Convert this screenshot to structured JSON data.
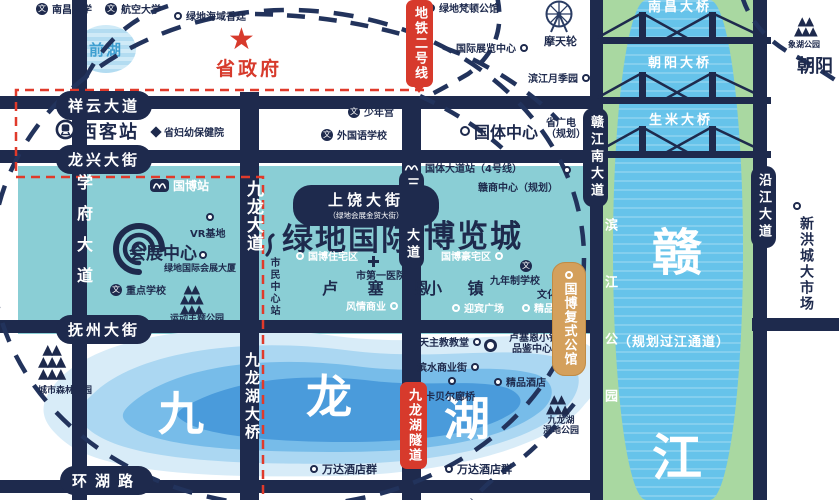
{
  "colors": {
    "navy": "#1e2a4d",
    "teal": "#8aced5",
    "red": "#d73a2c",
    "gold": "#d4a05c",
    "water_blue": "#66c3ea",
    "bank_green": "#a9d8a1",
    "lake_core_blue": "#4a9bdb",
    "qianhu_blue": "#b3dcf1"
  },
  "icons": {
    "star": "★",
    "school_glyph": "文",
    "mountain_row_small": "▲▲",
    "mountain_row_large": "▲▲▲"
  },
  "top": {
    "nanchang_university": "南昌大学",
    "aviation_university": "航空大学",
    "greenland_haiyu": "绿地海域香廷",
    "greenland_fandun": "绿地梵顿公馆",
    "qianhu_lake": "前湖",
    "provincial_government": "省政府",
    "intl_exhibition_center": "国际展览中心",
    "ferris_wheel": "摩天轮",
    "binjiang_rose_garden": "滨江月季园",
    "youth_palace": "少年宫",
    "foreign_language_school": "外国语学校",
    "provincial_maternity_hospital": "省妇幼保健院",
    "guoti_center": "国体中心",
    "provincial_tv_line1": "省广电",
    "provincial_tv_line2": "（规划）",
    "xianghu_park": "象湖公园",
    "chaoyang_district": "朝阳"
  },
  "metro": {
    "line2_banner": "地铁二号线",
    "west_station": "西客站",
    "guobo_station": "国博站",
    "guoti_avenue_station": "国体大道站（4号线）",
    "civic_center_station": "市民中心站"
  },
  "roads": {
    "xiangyun_avenue": "祥云大道",
    "longxing_street": "龙兴大街",
    "fuzhou_street": "抚州大街",
    "huanhu_road": "环湖路",
    "xuefu_avenue": "学府大道",
    "jiulong_avenue": "九龙大道",
    "sanqingshan_avenue": "三清山大道",
    "ganjiangnan_avenue": "赣江南大道",
    "yanjiang_avenue": "沿江大道",
    "shangrao_street": "上饶大街",
    "shangrao_street_sub": "（绿地会展金贸大街）"
  },
  "bridges": {
    "nanchang": "南昌大桥",
    "chaoyang": "朝阳大桥",
    "shengmi": "生米大桥",
    "jiulonghu_bridge": "九龙湖大桥",
    "jiulonghu_tunnel": "九龙湖隧道"
  },
  "project": {
    "greenland_intl": "绿地国际",
    "expo_city": "博览城",
    "convention_center": "会展中心",
    "lucerne_town_left": "卢 塞 恩",
    "lucerne_town_right": "小 镇",
    "guobo_duplex_mansion": "国博复式公馆",
    "vr_base": "VR基地",
    "greenland_conv_tower": "绿地国际会展大厦",
    "key_school": "重点学校",
    "sports_theme_park": "运动主题公园",
    "guobo_residential": "国博住宅区",
    "city_first_hospital": "市第一医院",
    "guobo_luxury": "国博豪宅区",
    "nine_year_school": "九年制学校",
    "culture_center": "文化中心",
    "fengqing_commerce": "风情商业",
    "yingbin_plaza": "迎宾广场",
    "boutique_hotel_1": "精品酒店",
    "boutique_hotel_2": "精品酒店",
    "ganshang_center": "赣商中心（规划）",
    "catholic_church": "天主教教堂",
    "lucerne_tasting_line1": "卢塞恩小镇",
    "lucerne_tasting_line2": "品鉴中心",
    "binshui_street": "滨水商业街",
    "kabeier_bridge": "卡贝尔廊桥",
    "wanda_hotels_1": "万达酒店群",
    "wanda_hotels_2": "万达酒店群"
  },
  "nature": {
    "city_forest_park": "城市森林公园",
    "jiulonghu_wetland_line1": "九龙湖",
    "jiulonghu_wetland_line2": "湿地公园",
    "binjiang_park": "滨江公园",
    "xinhongcheng_market": "新洪城大市场",
    "planned_crossing": "（规划过江通道）",
    "gan_char": "赣",
    "jiang_char": "江",
    "jiu_char": "九",
    "long_char": "龙",
    "hu_char": "湖"
  }
}
